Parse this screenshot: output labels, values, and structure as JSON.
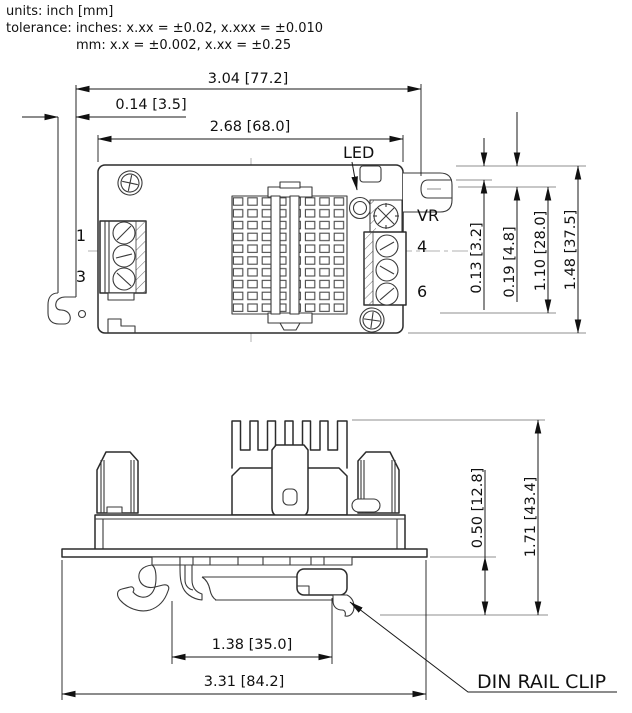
{
  "header": {
    "units_line": "units: inch [mm]",
    "tolerance_line1": "tolerance: inches: x.xx = ±0.02, x.xxx = ±0.010",
    "tolerance_line2": "mm: x.x = ±0.002, x.xx = ±0.25"
  },
  "top_view": {
    "dims": {
      "overall_width": "3.04 [77.2]",
      "clip_tab": "0.14 [3.5]",
      "body_width": "2.68 [68.0]",
      "slot_offset": "0.13 [3.2]",
      "slot_depth": "0.19 [4.8]",
      "slot_spacing": "1.10 [28.0]",
      "body_height": "1.48 [37.5]"
    },
    "labels": {
      "led": "LED",
      "vr": "VR",
      "pin1": "1",
      "pin3": "3",
      "pin4": "4",
      "pin6": "6"
    }
  },
  "side_view": {
    "dims": {
      "clip_depth": "0.50 [12.8]",
      "overall_height": "1.71 [43.4]",
      "rail_width": "1.38 [35.0]",
      "overall_width": "3.31 [84.2]"
    },
    "labels": {
      "din_rail_clip": "DIN RAIL CLIP"
    }
  },
  "colors": {
    "line": "#2b2b2b",
    "dim_line": "#1a1a1a",
    "centerline": "#b0b0b0",
    "background": "#ffffff"
  }
}
